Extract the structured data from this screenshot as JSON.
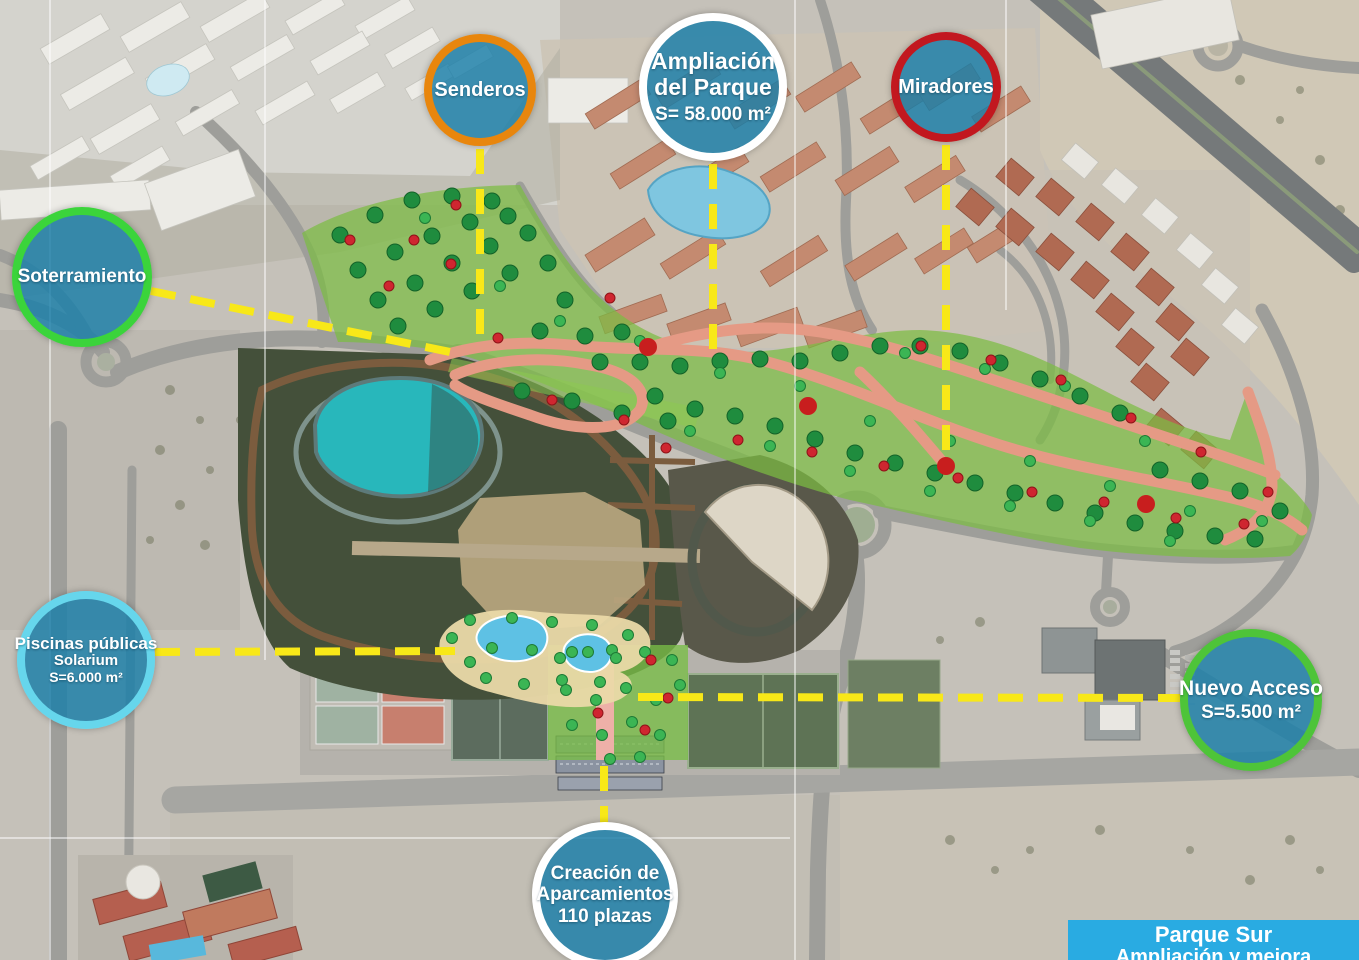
{
  "title_box": {
    "line1": "Parque Sur",
    "line2": "Ampliación y mejora",
    "bg_color": "#29ABE2",
    "text_color": "#FFFFFF"
  },
  "bubbles": {
    "fill_color": "rgba(24,126,168,0.82)",
    "senderos": {
      "label": "Senderos",
      "ring_color": "#E8860D"
    },
    "ampliacion_del_parque": {
      "line1": "Ampliación",
      "line2": "del Parque",
      "line3": "S= 58.000 m²",
      "ring_color": "#FFFFFF"
    },
    "miradores": {
      "label": "Miradores",
      "ring_color": "#C2181F"
    },
    "soterramiento": {
      "label": "Soterramiento",
      "ring_color": "#3BD43B"
    },
    "piscinas_publicas": {
      "line1": "Piscinas públicas",
      "line2": "Solarium",
      "line3": "S=6.000 m²",
      "ring_color": "#66D6EC"
    },
    "nuevo_acceso": {
      "line1": "Nuevo Acceso",
      "line2": "S=5.500 m²",
      "ring_color": "#4EC439"
    },
    "aparcamientos": {
      "line1": "Creación de",
      "line2": "Aparcamientos",
      "line3": "110 plazas",
      "ring_color": "#FFFFFF"
    }
  },
  "connectors": {
    "color": "#F8E818"
  },
  "map": {
    "colors": {
      "extension_green": "rgba(124,188,66,0.72)",
      "existing_park": "#44503a",
      "lake": "#28b7bb",
      "path_salmon": "#e59a85",
      "road_gray": "#9e9e9a"
    },
    "symbols": {
      "tree_color": "#1f8c3e",
      "palm_color": "#3bb554",
      "flower_color": "#cf2630",
      "viewpoint_color": "#c81e1e",
      "trees": [
        [
          340,
          235
        ],
        [
          375,
          215
        ],
        [
          412,
          200
        ],
        [
          452,
          196
        ],
        [
          492,
          201
        ],
        [
          358,
          270
        ],
        [
          395,
          252
        ],
        [
          432,
          236
        ],
        [
          470,
          222
        ],
        [
          508,
          216
        ],
        [
          378,
          300
        ],
        [
          415,
          283
        ],
        [
          452,
          263
        ],
        [
          490,
          246
        ],
        [
          528,
          233
        ],
        [
          398,
          326
        ],
        [
          435,
          309
        ],
        [
          472,
          291
        ],
        [
          510,
          273
        ],
        [
          548,
          263
        ],
        [
          565,
          300
        ],
        [
          540,
          331
        ],
        [
          585,
          336
        ],
        [
          622,
          332
        ],
        [
          600,
          362
        ],
        [
          640,
          362
        ],
        [
          680,
          366
        ],
        [
          720,
          361
        ],
        [
          760,
          359
        ],
        [
          800,
          361
        ],
        [
          840,
          353
        ],
        [
          880,
          346
        ],
        [
          920,
          346
        ],
        [
          960,
          351
        ],
        [
          1000,
          363
        ],
        [
          1040,
          379
        ],
        [
          1080,
          396
        ],
        [
          1120,
          413
        ],
        [
          655,
          396
        ],
        [
          695,
          409
        ],
        [
          735,
          416
        ],
        [
          775,
          426
        ],
        [
          815,
          439
        ],
        [
          855,
          453
        ],
        [
          895,
          463
        ],
        [
          935,
          473
        ],
        [
          975,
          483
        ],
        [
          1015,
          493
        ],
        [
          1055,
          503
        ],
        [
          1095,
          513
        ],
        [
          1135,
          523
        ],
        [
          1175,
          531
        ],
        [
          1215,
          536
        ],
        [
          1255,
          539
        ],
        [
          1160,
          470
        ],
        [
          1200,
          481
        ],
        [
          1240,
          491
        ],
        [
          1280,
          511
        ],
        [
          522,
          391
        ],
        [
          572,
          401
        ],
        [
          622,
          413
        ],
        [
          668,
          421
        ]
      ],
      "palms": [
        [
          425,
          218
        ],
        [
          500,
          286
        ],
        [
          560,
          321
        ],
        [
          640,
          341
        ],
        [
          720,
          373
        ],
        [
          800,
          386
        ],
        [
          870,
          421
        ],
        [
          950,
          441
        ],
        [
          1030,
          461
        ],
        [
          1110,
          486
        ],
        [
          1190,
          511
        ],
        [
          1262,
          521
        ],
        [
          905,
          353
        ],
        [
          985,
          369
        ],
        [
          1065,
          386
        ],
        [
          1145,
          441
        ],
        [
          690,
          431
        ],
        [
          770,
          446
        ],
        [
          850,
          471
        ],
        [
          930,
          491
        ],
        [
          1010,
          506
        ],
        [
          1090,
          521
        ],
        [
          1170,
          541
        ],
        [
          452,
          638
        ],
        [
          470,
          620
        ],
        [
          492,
          648
        ],
        [
          512,
          618
        ],
        [
          532,
          650
        ],
        [
          552,
          622
        ],
        [
          572,
          652
        ],
        [
          592,
          625
        ],
        [
          612,
          650
        ],
        [
          628,
          635
        ],
        [
          486,
          678
        ],
        [
          524,
          684
        ],
        [
          562,
          680
        ],
        [
          600,
          682
        ],
        [
          470,
          662
        ],
        [
          560,
          658
        ],
        [
          588,
          652
        ],
        [
          616,
          658
        ],
        [
          645,
          652
        ],
        [
          672,
          660
        ],
        [
          566,
          690
        ],
        [
          596,
          700
        ],
        [
          626,
          688
        ],
        [
          656,
          700
        ],
        [
          680,
          685
        ],
        [
          572,
          725
        ],
        [
          602,
          735
        ],
        [
          632,
          722
        ],
        [
          660,
          735
        ],
        [
          640,
          757
        ],
        [
          610,
          759
        ]
      ],
      "flowers": [
        [
          456,
          205
        ],
        [
          414,
          240
        ],
        [
          350,
          240
        ],
        [
          389,
          286
        ],
        [
          451,
          264
        ],
        [
          498,
          338
        ],
        [
          552,
          400
        ],
        [
          624,
          420
        ],
        [
          610,
          298
        ],
        [
          666,
          448
        ],
        [
          738,
          440
        ],
        [
          812,
          452
        ],
        [
          884,
          466
        ],
        [
          958,
          478
        ],
        [
          1032,
          492
        ],
        [
          1104,
          502
        ],
        [
          1176,
          518
        ],
        [
          1244,
          524
        ],
        [
          921,
          346
        ],
        [
          991,
          360
        ],
        [
          1061,
          380
        ],
        [
          1131,
          418
        ],
        [
          1201,
          452
        ],
        [
          1268,
          492
        ],
        [
          651,
          660
        ],
        [
          668,
          698
        ],
        [
          645,
          730
        ],
        [
          598,
          713
        ]
      ],
      "viewpoints": [
        [
          648,
          347
        ],
        [
          808,
          406
        ],
        [
          946,
          466
        ],
        [
          1146,
          504
        ]
      ]
    }
  }
}
